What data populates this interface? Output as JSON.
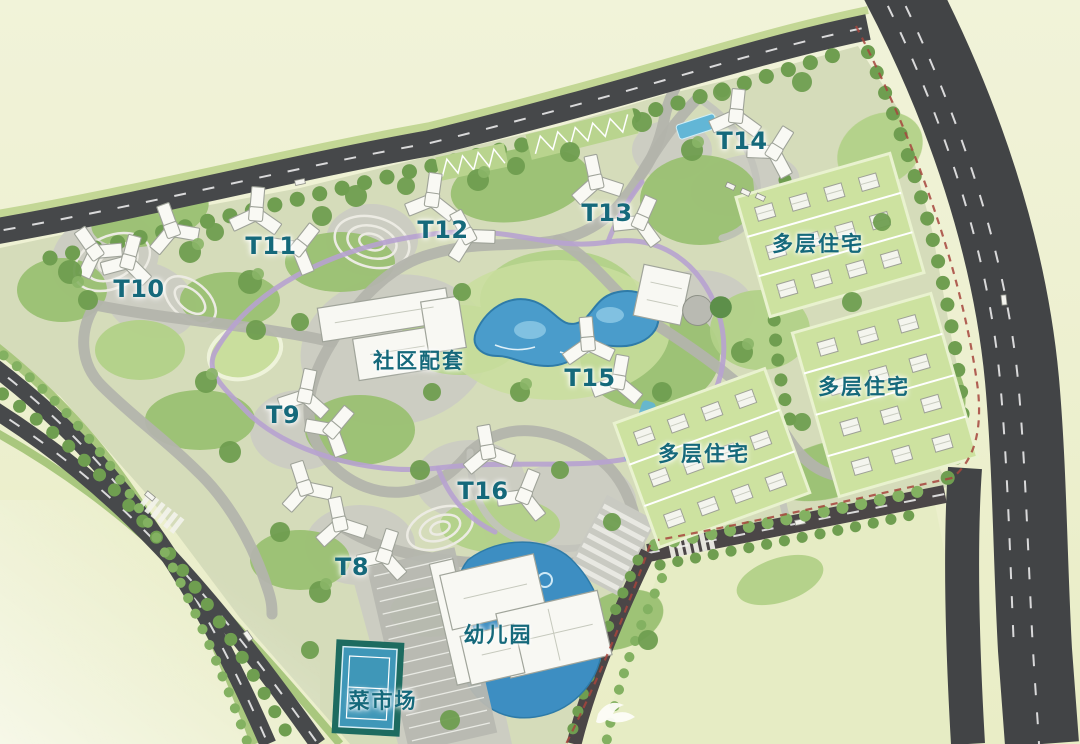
{
  "map": {
    "type": "residential-master-plan",
    "labels": {
      "towers": [
        {
          "id": "t8",
          "text": "T8"
        },
        {
          "id": "t9",
          "text": "T9"
        },
        {
          "id": "t10",
          "text": "T10"
        },
        {
          "id": "t11",
          "text": "T11"
        },
        {
          "id": "t12",
          "text": "T12"
        },
        {
          "id": "t13",
          "text": "T13"
        },
        {
          "id": "t14",
          "text": "T14"
        },
        {
          "id": "t15",
          "text": "T15"
        },
        {
          "id": "t16",
          "text": "T16"
        }
      ],
      "facilities": {
        "community": "社区配套",
        "kindergarten": "幼儿园",
        "market": "菜市场"
      },
      "residential_zones": [
        {
          "id": "multi-north",
          "text": "多层住宅"
        },
        {
          "id": "multi-east",
          "text": "多层住宅"
        },
        {
          "id": "multi-south",
          "text": "多层住宅"
        }
      ]
    },
    "colors": {
      "label_teal": "#15697b",
      "road_dark": "#47494b",
      "water_blue": "#4094c4",
      "greenery": "#8fb968",
      "lawn": "#c8dd9c",
      "background": "#eef0d0",
      "path_purple": "#b7a2d0",
      "boundary_red": "#a6453d",
      "building_white": "#f8f8f3"
    }
  }
}
